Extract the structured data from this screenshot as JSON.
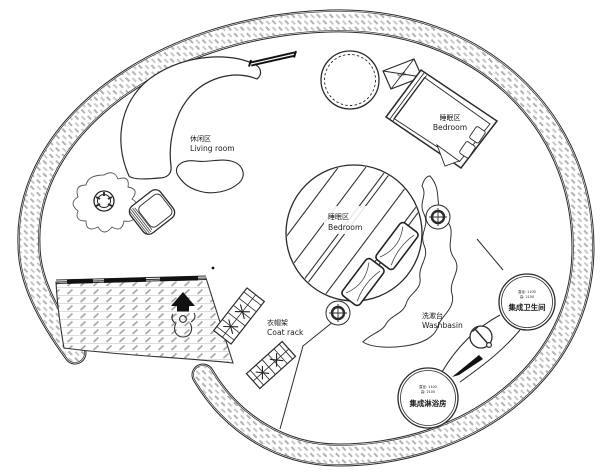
{
  "labels": {
    "living_room": {
      "zh": "休闲区",
      "en": "Living room"
    },
    "bedroom_upper": {
      "zh": "睡眠区",
      "en": "Bedroom"
    },
    "bedroom_loft": {
      "zh": "睡眠区",
      "en": "Bedroom"
    },
    "coat_rack": {
      "zh": "衣帽架",
      "en": "Coat rack"
    },
    "washbasin": {
      "zh": "洗漱台",
      "en": "Washbasin"
    },
    "toilet_pod": {
      "dim1": "直径: 1100",
      "dim2": "高: 2100",
      "name": "集成卫生间"
    },
    "shower_pod": {
      "dim1": "直径: 1100",
      "dim2": "高: 2100",
      "name": "集成淋浴房"
    },
    "ac_unit": "空调"
  },
  "colors": {
    "line": "#2b2b2b",
    "wall_hatch": "#b3b3b3",
    "floor_hatch": "#a8a8a8",
    "dark_fill": "#111111",
    "background": "#ffffff",
    "text": "#1a1a1a"
  }
}
